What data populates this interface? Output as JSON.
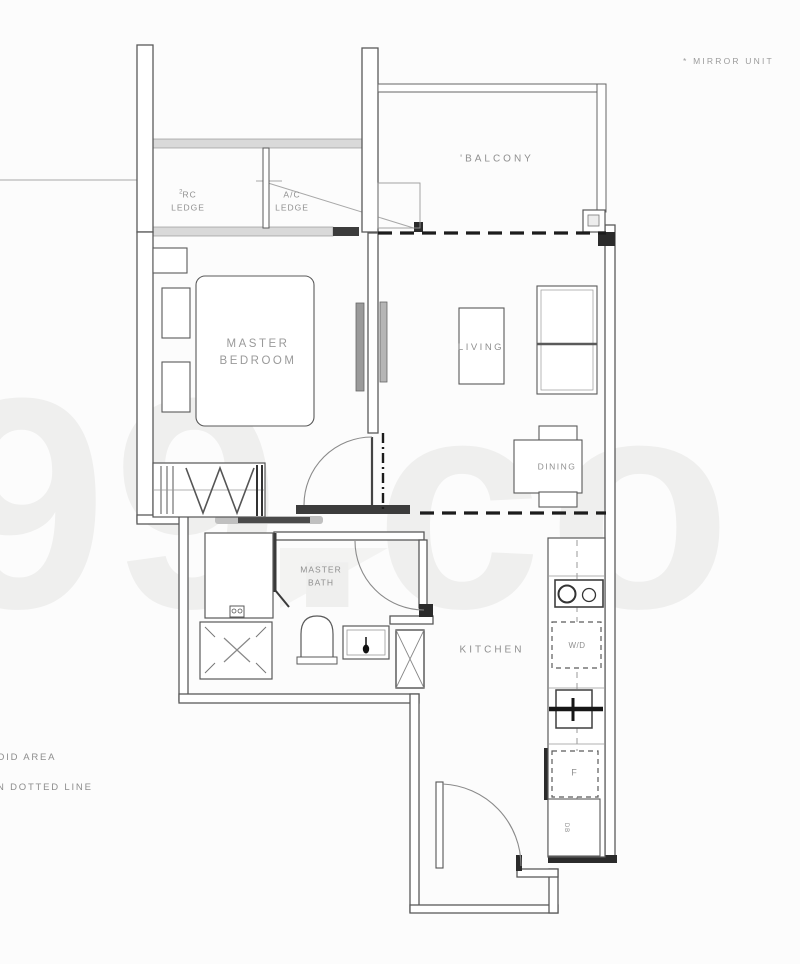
{
  "watermark": "99.co",
  "annotations": {
    "mirror_note": "* MIRROR UNIT",
    "legend_line1": "OID AREA",
    "legend_line2": "N DOTTED LINE"
  },
  "rooms": {
    "balcony_mark": "'",
    "balcony": "BALCONY",
    "rc_ledge_sup": "2",
    "rc_ledge_l1": "RC",
    "rc_ledge_l2": "LEDGE",
    "ac_ledge_l1": "A/C",
    "ac_ledge_l2": "LEDGE",
    "master_bedroom_l1": "MASTER",
    "master_bedroom_l2": "BEDROOM",
    "living": "LIVING",
    "dining": "DINING",
    "master_bath_l1": "MASTER",
    "master_bath_l2": "BATH",
    "kitchen": "KITCHEN"
  },
  "appliances": {
    "washer_dryer": "W/D",
    "fridge": "F",
    "db": "DB"
  },
  "colors": {
    "wall_fill": "#d9d9d9",
    "dark_wall": "#2f2f2f",
    "line": "#5a5a5a",
    "label": "#8f8f8f",
    "background": "#fcfcfc"
  }
}
